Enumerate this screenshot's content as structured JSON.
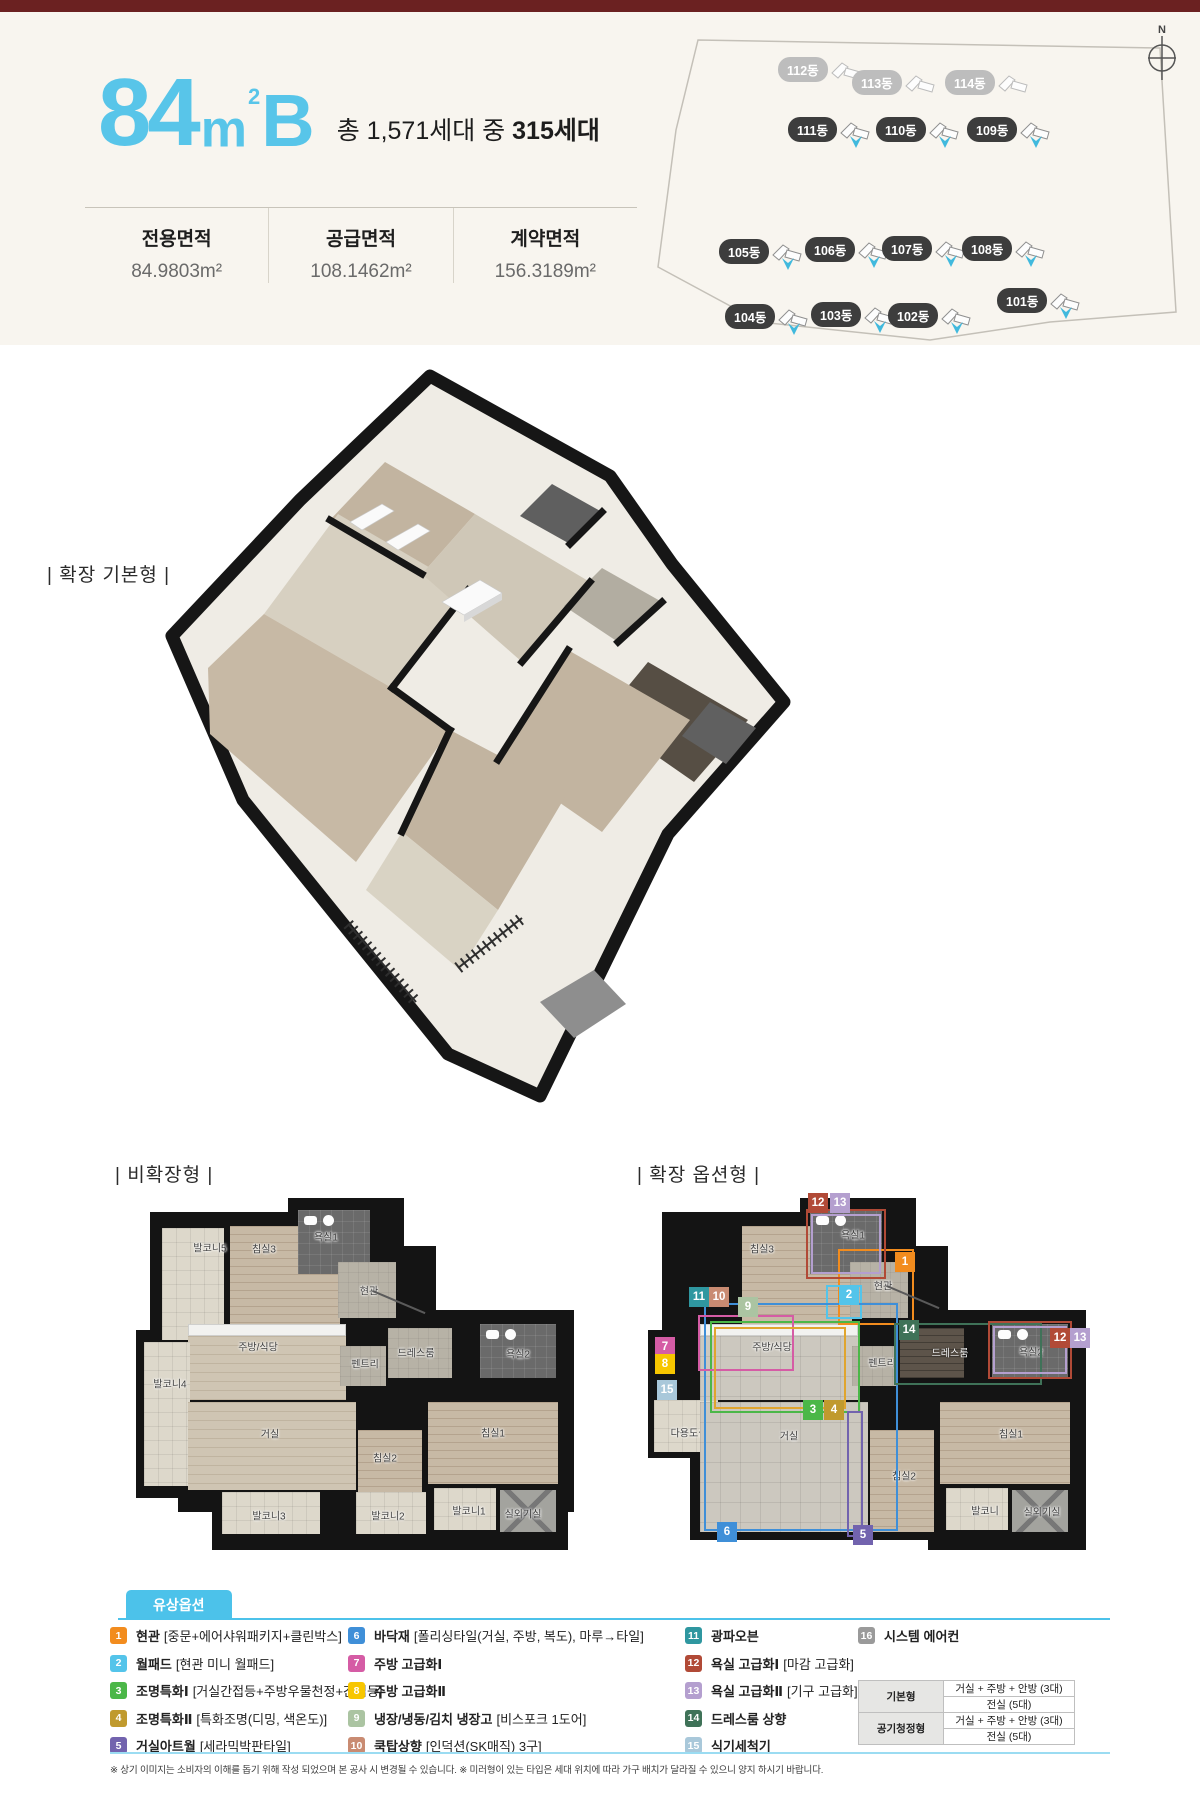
{
  "colors": {
    "topbar": "#6b2121",
    "header_bg": "#f8f5ef",
    "accent_cyan": "#58c5e9",
    "legend_cyan": "#4cc2ea"
  },
  "header": {
    "title": {
      "number": "84",
      "unit": "m",
      "sup": "2",
      "variant": "B"
    },
    "units_prefix": "총 1,571세대 중 ",
    "units_bold": "315세대",
    "areas": [
      {
        "label": "전용면적",
        "value": "84.9803m²"
      },
      {
        "label": "공급면적",
        "value": "108.1462m²"
      },
      {
        "label": "계약면적",
        "value": "156.3189m²"
      }
    ]
  },
  "site_map": {
    "compass_label": "N",
    "buildings": [
      {
        "label": "112동",
        "x": 188,
        "y": 58,
        "style": "muted"
      },
      {
        "label": "113동",
        "x": 262,
        "y": 71,
        "style": "muted"
      },
      {
        "label": "114동",
        "x": 355,
        "y": 71,
        "style": "muted"
      },
      {
        "label": "111동",
        "x": 198,
        "y": 118,
        "style": "dark"
      },
      {
        "label": "110동",
        "x": 286,
        "y": 118,
        "style": "dark"
      },
      {
        "label": "109동",
        "x": 377,
        "y": 118,
        "style": "dark"
      },
      {
        "label": "105동",
        "x": 129,
        "y": 240,
        "style": "dark"
      },
      {
        "label": "106동",
        "x": 215,
        "y": 238,
        "style": "dark"
      },
      {
        "label": "107동",
        "x": 292,
        "y": 237,
        "style": "dark"
      },
      {
        "label": "108동",
        "x": 372,
        "y": 237,
        "style": "dark"
      },
      {
        "label": "104동",
        "x": 135,
        "y": 305,
        "style": "dark"
      },
      {
        "label": "103동",
        "x": 221,
        "y": 303,
        "style": "dark"
      },
      {
        "label": "102동",
        "x": 298,
        "y": 304,
        "style": "dark"
      },
      {
        "label": "101동",
        "x": 407,
        "y": 289,
        "style": "dark"
      }
    ]
  },
  "sections": {
    "iso": "| 확장 기본형 |",
    "left": "| 비확장형 |",
    "right": "| 확장 옵션형 |"
  },
  "plans": {
    "left": {
      "x": 128,
      "y": 1198,
      "walls": [
        [
          22,
          14,
          246,
          200
        ],
        [
          160,
          0,
          116,
          92
        ],
        [
          196,
          48,
          112,
          96
        ],
        [
          250,
          112,
          196,
          96
        ],
        [
          8,
          132,
          64,
          168
        ],
        [
          50,
          192,
          396,
          122
        ],
        [
          84,
          284,
          356,
          68
        ]
      ],
      "rooms": [
        {
          "label": "발코니5",
          "x": 34,
          "y": 30,
          "w": 62,
          "h": 112,
          "t": "tile",
          "lx": 82,
          "ly": 49
        },
        {
          "label": "침실3",
          "x": 102,
          "y": 28,
          "w": 110,
          "h": 150,
          "t": "wood",
          "lx": 136,
          "ly": 50
        },
        {
          "label": "욕실1",
          "x": 170,
          "y": 12,
          "w": 72,
          "h": 64,
          "t": "dark",
          "lx": 198,
          "ly": 38
        },
        {
          "label": "현관",
          "x": 210,
          "y": 64,
          "w": 58,
          "h": 56,
          "t": "gray",
          "lx": 241,
          "ly": 92
        },
        {
          "label": "",
          "x": 60,
          "y": 126,
          "w": 158,
          "h": 12,
          "t": "counter"
        },
        {
          "label": "주방/식당",
          "x": 60,
          "y": 138,
          "w": 158,
          "h": 64,
          "t": "wood2",
          "lx": 130,
          "ly": 148
        },
        {
          "label": "발코니4",
          "x": 16,
          "y": 144,
          "w": 46,
          "h": 144,
          "t": "tile",
          "lx": 42,
          "ly": 185
        },
        {
          "label": "펜트리",
          "x": 212,
          "y": 148,
          "w": 46,
          "h": 40,
          "t": "gray",
          "lx": 237,
          "ly": 165
        },
        {
          "label": "드레스룸",
          "x": 260,
          "y": 130,
          "w": 64,
          "h": 50,
          "t": "gray",
          "lx": 288,
          "ly": 154
        },
        {
          "label": "욕실2",
          "x": 352,
          "y": 126,
          "w": 76,
          "h": 54,
          "t": "dark",
          "lx": 390,
          "ly": 155
        },
        {
          "label": "거실",
          "x": 60,
          "y": 204,
          "w": 168,
          "h": 88,
          "t": "wood2",
          "lx": 142,
          "ly": 235
        },
        {
          "label": "침실2",
          "x": 230,
          "y": 232,
          "w": 64,
          "h": 66,
          "t": "wood",
          "lx": 257,
          "ly": 259
        },
        {
          "label": "침실1",
          "x": 300,
          "y": 204,
          "w": 130,
          "h": 82,
          "t": "wood",
          "lx": 365,
          "ly": 234
        },
        {
          "label": "발코니3",
          "x": 94,
          "y": 294,
          "w": 98,
          "h": 42,
          "t": "tile",
          "lx": 141,
          "ly": 317
        },
        {
          "label": "발코니2",
          "x": 228,
          "y": 294,
          "w": 70,
          "h": 42,
          "t": "tile",
          "lx": 260,
          "ly": 317
        },
        {
          "label": "발코니1",
          "x": 306,
          "y": 290,
          "w": 62,
          "h": 42,
          "t": "tile",
          "lx": 341,
          "ly": 312
        },
        {
          "label": "실외기실",
          "x": 372,
          "y": 292,
          "w": 56,
          "h": 42,
          "t": "ac",
          "lx": 395,
          "ly": 315
        }
      ],
      "badges": [],
      "outlines": [],
      "pointer": {
        "x": 245,
        "y": 92,
        "len": 57,
        "deg": 23
      }
    },
    "right": {
      "x": 640,
      "y": 1198,
      "walls": [
        [
          22,
          14,
          246,
          200
        ],
        [
          160,
          0,
          116,
          92
        ],
        [
          196,
          48,
          112,
          96
        ],
        [
          250,
          112,
          196,
          96
        ],
        [
          8,
          132,
          64,
          100
        ],
        [
          8,
          196,
          76,
          64
        ],
        [
          50,
          192,
          396,
          150
        ],
        [
          288,
          284,
          158,
          68
        ]
      ],
      "rooms": [
        {
          "label": "침실3",
          "x": 102,
          "y": 28,
          "w": 110,
          "h": 150,
          "t": "wood",
          "lx": 122,
          "ly": 50
        },
        {
          "label": "욕실1",
          "x": 170,
          "y": 12,
          "w": 72,
          "h": 64,
          "t": "dark",
          "lx": 213,
          "ly": 36
        },
        {
          "label": "현관",
          "x": 210,
          "y": 64,
          "w": 58,
          "h": 56,
          "t": "gray",
          "lx": 243,
          "ly": 87
        },
        {
          "label": "",
          "x": 60,
          "y": 126,
          "w": 158,
          "h": 12,
          "t": "counter"
        },
        {
          "label": "주방/식당",
          "x": 60,
          "y": 138,
          "w": 158,
          "h": 64,
          "t": "tile2",
          "lx": 132,
          "ly": 148
        },
        {
          "label": "펜트리",
          "x": 212,
          "y": 148,
          "w": 46,
          "h": 40,
          "t": "gray",
          "lx": 242,
          "ly": 164
        },
        {
          "label": "드레스룸",
          "x": 260,
          "y": 130,
          "w": 64,
          "h": 50,
          "t": "darkwood",
          "lx": 310,
          "ly": 154,
          "light": true
        },
        {
          "label": "욕실2",
          "x": 352,
          "y": 126,
          "w": 76,
          "h": 54,
          "t": "dark",
          "lx": 391,
          "ly": 153
        },
        {
          "label": "다용도실",
          "x": 14,
          "y": 202,
          "w": 64,
          "h": 52,
          "t": "tile",
          "lx": 49,
          "ly": 234
        },
        {
          "label": "거실",
          "x": 60,
          "y": 204,
          "w": 168,
          "h": 130,
          "t": "tile2",
          "lx": 149,
          "ly": 237
        },
        {
          "label": "침실2",
          "x": 230,
          "y": 232,
          "w": 64,
          "h": 102,
          "t": "wood",
          "lx": 264,
          "ly": 277
        },
        {
          "label": "침실1",
          "x": 300,
          "y": 204,
          "w": 130,
          "h": 82,
          "t": "wood",
          "lx": 371,
          "ly": 235
        },
        {
          "label": "발코니",
          "x": 306,
          "y": 290,
          "w": 62,
          "h": 42,
          "t": "tile",
          "lx": 345,
          "ly": 312
        },
        {
          "label": "실외기실",
          "x": 372,
          "y": 292,
          "w": 56,
          "h": 42,
          "t": "ac",
          "lx": 402,
          "ly": 313
        }
      ],
      "outlines": [
        {
          "color": "#f28c1e",
          "x": 198,
          "y": 51,
          "w": 76,
          "h": 76
        },
        {
          "color": "#54c4ea",
          "x": 186,
          "y": 87,
          "w": 36,
          "h": 34
        },
        {
          "color": "#3f8fd8",
          "x": 64,
          "y": 105,
          "w": 194,
          "h": 228
        },
        {
          "color": "#4bb748",
          "x": 70,
          "y": 123,
          "w": 150,
          "h": 92
        },
        {
          "color": "#d55ca5",
          "x": 58,
          "y": 117,
          "w": 96,
          "h": 56
        },
        {
          "color": "#e0a52e",
          "x": 74,
          "y": 129,
          "w": 132,
          "h": 82
        },
        {
          "color": "#3f7258",
          "x": 254,
          "y": 125,
          "w": 148,
          "h": 62
        },
        {
          "color": "#7263ae",
          "x": 207,
          "y": 213,
          "w": 16,
          "h": 126
        },
        {
          "color": "#b14a37",
          "x": 166,
          "y": 11,
          "w": 80,
          "h": 70
        },
        {
          "color": "#b49fcf",
          "x": 171,
          "y": 16,
          "w": 70,
          "h": 60
        },
        {
          "color": "#b14a37",
          "x": 348,
          "y": 123,
          "w": 84,
          "h": 58
        },
        {
          "color": "#b49fcf",
          "x": 353,
          "y": 128,
          "w": 74,
          "h": 48
        }
      ],
      "badges": [
        {
          "n": "12",
          "x": 168,
          "y": -5
        },
        {
          "n": "13",
          "x": 190,
          "y": -5
        },
        {
          "n": "1",
          "x": 255,
          "y": 54
        },
        {
          "n": "2",
          "x": 199,
          "y": 87
        },
        {
          "n": "11",
          "x": 49,
          "y": 89
        },
        {
          "n": "10",
          "x": 69,
          "y": 89
        },
        {
          "n": "9",
          "x": 98,
          "y": 99
        },
        {
          "n": "7",
          "x": 15,
          "y": 139
        },
        {
          "n": "8",
          "x": 15,
          "y": 156
        },
        {
          "n": "15",
          "x": 17,
          "y": 182
        },
        {
          "n": "14",
          "x": 259,
          "y": 122
        },
        {
          "n": "12",
          "x": 410,
          "y": 130
        },
        {
          "n": "13",
          "x": 430,
          "y": 130
        },
        {
          "n": "3",
          "x": 163,
          "y": 202
        },
        {
          "n": "4",
          "x": 184,
          "y": 202
        },
        {
          "n": "6",
          "x": 77,
          "y": 324
        },
        {
          "n": "5",
          "x": 213,
          "y": 327
        }
      ],
      "pointer": {
        "x": 247,
        "y": 87,
        "len": 57,
        "deg": 23
      }
    }
  },
  "legend": {
    "title": "유상옵션",
    "items": [
      {
        "num": "1",
        "name": "현관",
        "desc": "[중문+에어샤워패키지+클린박스]",
        "color": "#f28c1e",
        "col": 0
      },
      {
        "num": "2",
        "name": "월패드",
        "desc": "[현관 미니 월패드]",
        "color": "#54c4ea",
        "col": 0
      },
      {
        "num": "3",
        "name": "조명특화Ⅰ",
        "desc": "[거실간접등+주방우물천정+간접등]",
        "color": "#4bb748",
        "col": 0
      },
      {
        "num": "4",
        "name": "조명특화Ⅱ",
        "desc": "[특화조명(디밍, 색온도)]",
        "color": "#c09a2e",
        "col": 0
      },
      {
        "num": "5",
        "name": "거실아트월",
        "desc": "[세라믹박판타일]",
        "color": "#7263ae",
        "col": 0
      },
      {
        "num": "6",
        "name": "바닥재",
        "desc": "[폴리싱타일(거실, 주방, 복도), 마루→타일]",
        "color": "#3f8fd8",
        "col": 1
      },
      {
        "num": "7",
        "name": "주방 고급화Ⅰ",
        "desc": "",
        "color": "#d55ca5",
        "col": 1
      },
      {
        "num": "8",
        "name": "주방 고급화Ⅱ",
        "desc": "",
        "color": "#f7c600",
        "col": 1
      },
      {
        "num": "9",
        "name": "냉장/냉동/김치 냉장고",
        "desc": "[비스포크 1도어]",
        "color": "#abc4a2",
        "col": 1
      },
      {
        "num": "10",
        "name": "쿡탑상향",
        "desc": "[인덕션(SK매직) 3구]",
        "color": "#c98b72",
        "col": 1
      },
      {
        "num": "11",
        "name": "광파오븐",
        "desc": "",
        "color": "#2f97a0",
        "col": 2
      },
      {
        "num": "12",
        "name": "욕실 고급화Ⅰ",
        "desc": "[마감 고급화]",
        "color": "#b14a37",
        "col": 2
      },
      {
        "num": "13",
        "name": "욕실 고급화Ⅱ",
        "desc": "[기구 고급화]",
        "color": "#b49fcf",
        "col": 2
      },
      {
        "num": "14",
        "name": "드레스룸 상향",
        "desc": "",
        "color": "#3f7258",
        "col": 2
      },
      {
        "num": "15",
        "name": "식기세척기",
        "desc": "",
        "color": "#a9c8da",
        "col": 2
      },
      {
        "num": "16",
        "name": "시스템 에어컨",
        "desc": "",
        "color": "#9a9a9a",
        "col": 3
      }
    ],
    "col_x": [
      0,
      238,
      575,
      748
    ],
    "aircon_table": {
      "rows": [
        {
          "header": "기본형",
          "values": [
            "거실 + 주방 + 안방 (3대)",
            "전실 (5대)"
          ]
        },
        {
          "header": "공기청정형",
          "values": [
            "거실 + 주방 + 안방 (3대)",
            "전실 (5대)"
          ]
        }
      ]
    }
  },
  "disclaimer": "※ 상기 이미지는 소비자의 이해를 돕기 위해 작성 되었으며 본 공사 시 변경될 수 있습니다. ※ 미러형이 있는 타입은 세대 위치에 따라 가구 배치가 달라질 수 있으니 양지 하시기 바랍니다."
}
